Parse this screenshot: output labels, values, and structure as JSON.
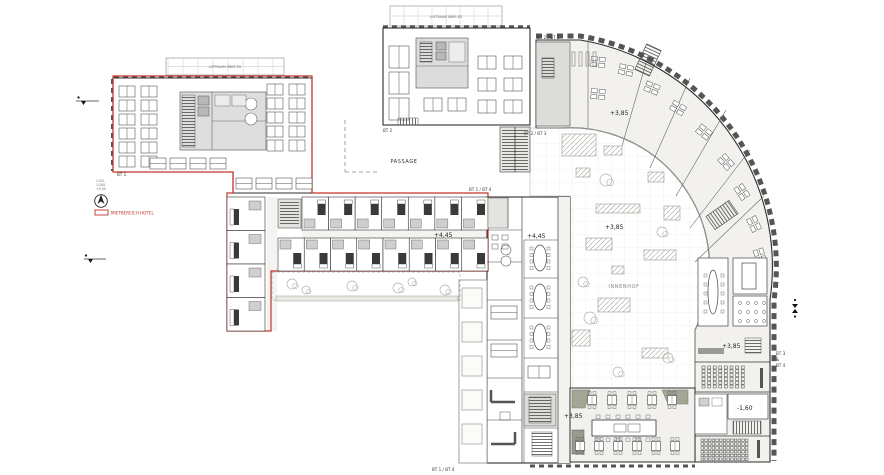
{
  "labels": {
    "bt1": "BT 1",
    "bt2": "BT 2",
    "bt2_bt3_top": "BT 2 / BT 3",
    "bt2_bt3_mid": "BT 2 / BT 3",
    "bt1_bt4_top": "BT 1 / BT 4",
    "bt1_bt4_bottom": "BT 1 / BT 4",
    "bt3": "BT 3",
    "ampersand": "&",
    "bt4": "BT 4",
    "passage": "PASSAGE",
    "innenhof": "INNENHOF",
    "luftraum_top": "LUFTRAUM ÜBER EG",
    "luftraum_left": "LUFTRAUM ÜBER EG"
  },
  "levels": {
    "hotel_corridor": "+4,45",
    "mid_wing": "+4,45",
    "arc_upper": "+3,85",
    "courtyard": "+3,85",
    "arc_right": "+3,85",
    "restaurant": "+3,85",
    "auditorium": "-1,60"
  },
  "legend": {
    "red_area_label": "MIETBEREICH HOTEL",
    "note_line1": "1.OG",
    "note_line2": "1:200",
    "note_line3": "+4,45"
  },
  "colors": {
    "red_outline": "#c2342c",
    "wall": "#2f2f2f",
    "core_gray": "#dcdcd8",
    "floor": "#f2f1ee",
    "terrace": "#a5a596"
  },
  "plan": {
    "hotel_rooms_top": 7,
    "hotel_rooms_bottom": 8,
    "hotel_rooms_west": 4,
    "mid_wing_meeting_rooms": 3,
    "restaurant_tables_row1": 5,
    "restaurant_tables_row2": 6,
    "seating_rows_upper": 6,
    "seating_cols_upper": 8,
    "seating_rows_lower": 6,
    "seating_cols_lower": 13,
    "arc_desk_clusters": 10,
    "colonnade_planters": 5
  }
}
